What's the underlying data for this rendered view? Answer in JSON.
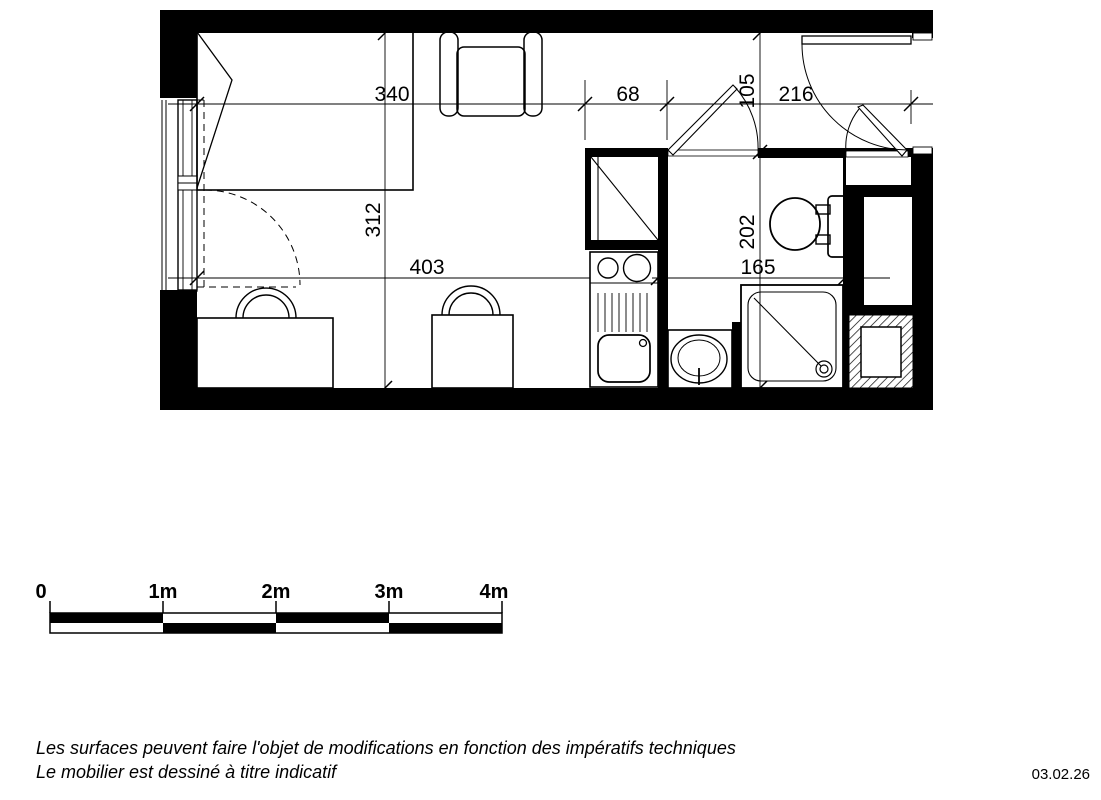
{
  "dimensions": {
    "top_left": "340",
    "top_mid": "68",
    "top_right": "216",
    "room_depth": "312",
    "bottom_left": "403",
    "bottom_right": "165",
    "hall_depth": "105",
    "bath_depth": "202"
  },
  "scale_bar": {
    "labels": [
      "0",
      "1m",
      "2m",
      "3m",
      "4m"
    ]
  },
  "footer": {
    "note_line1": "Les surfaces peuvent faire l'objet de modifications en fonction des impératifs techniques",
    "note_line2": "Le mobilier est dessiné à titre indicatif",
    "date": "03.02.26"
  },
  "colors": {
    "ink": "#000000",
    "paper": "#ffffff"
  }
}
